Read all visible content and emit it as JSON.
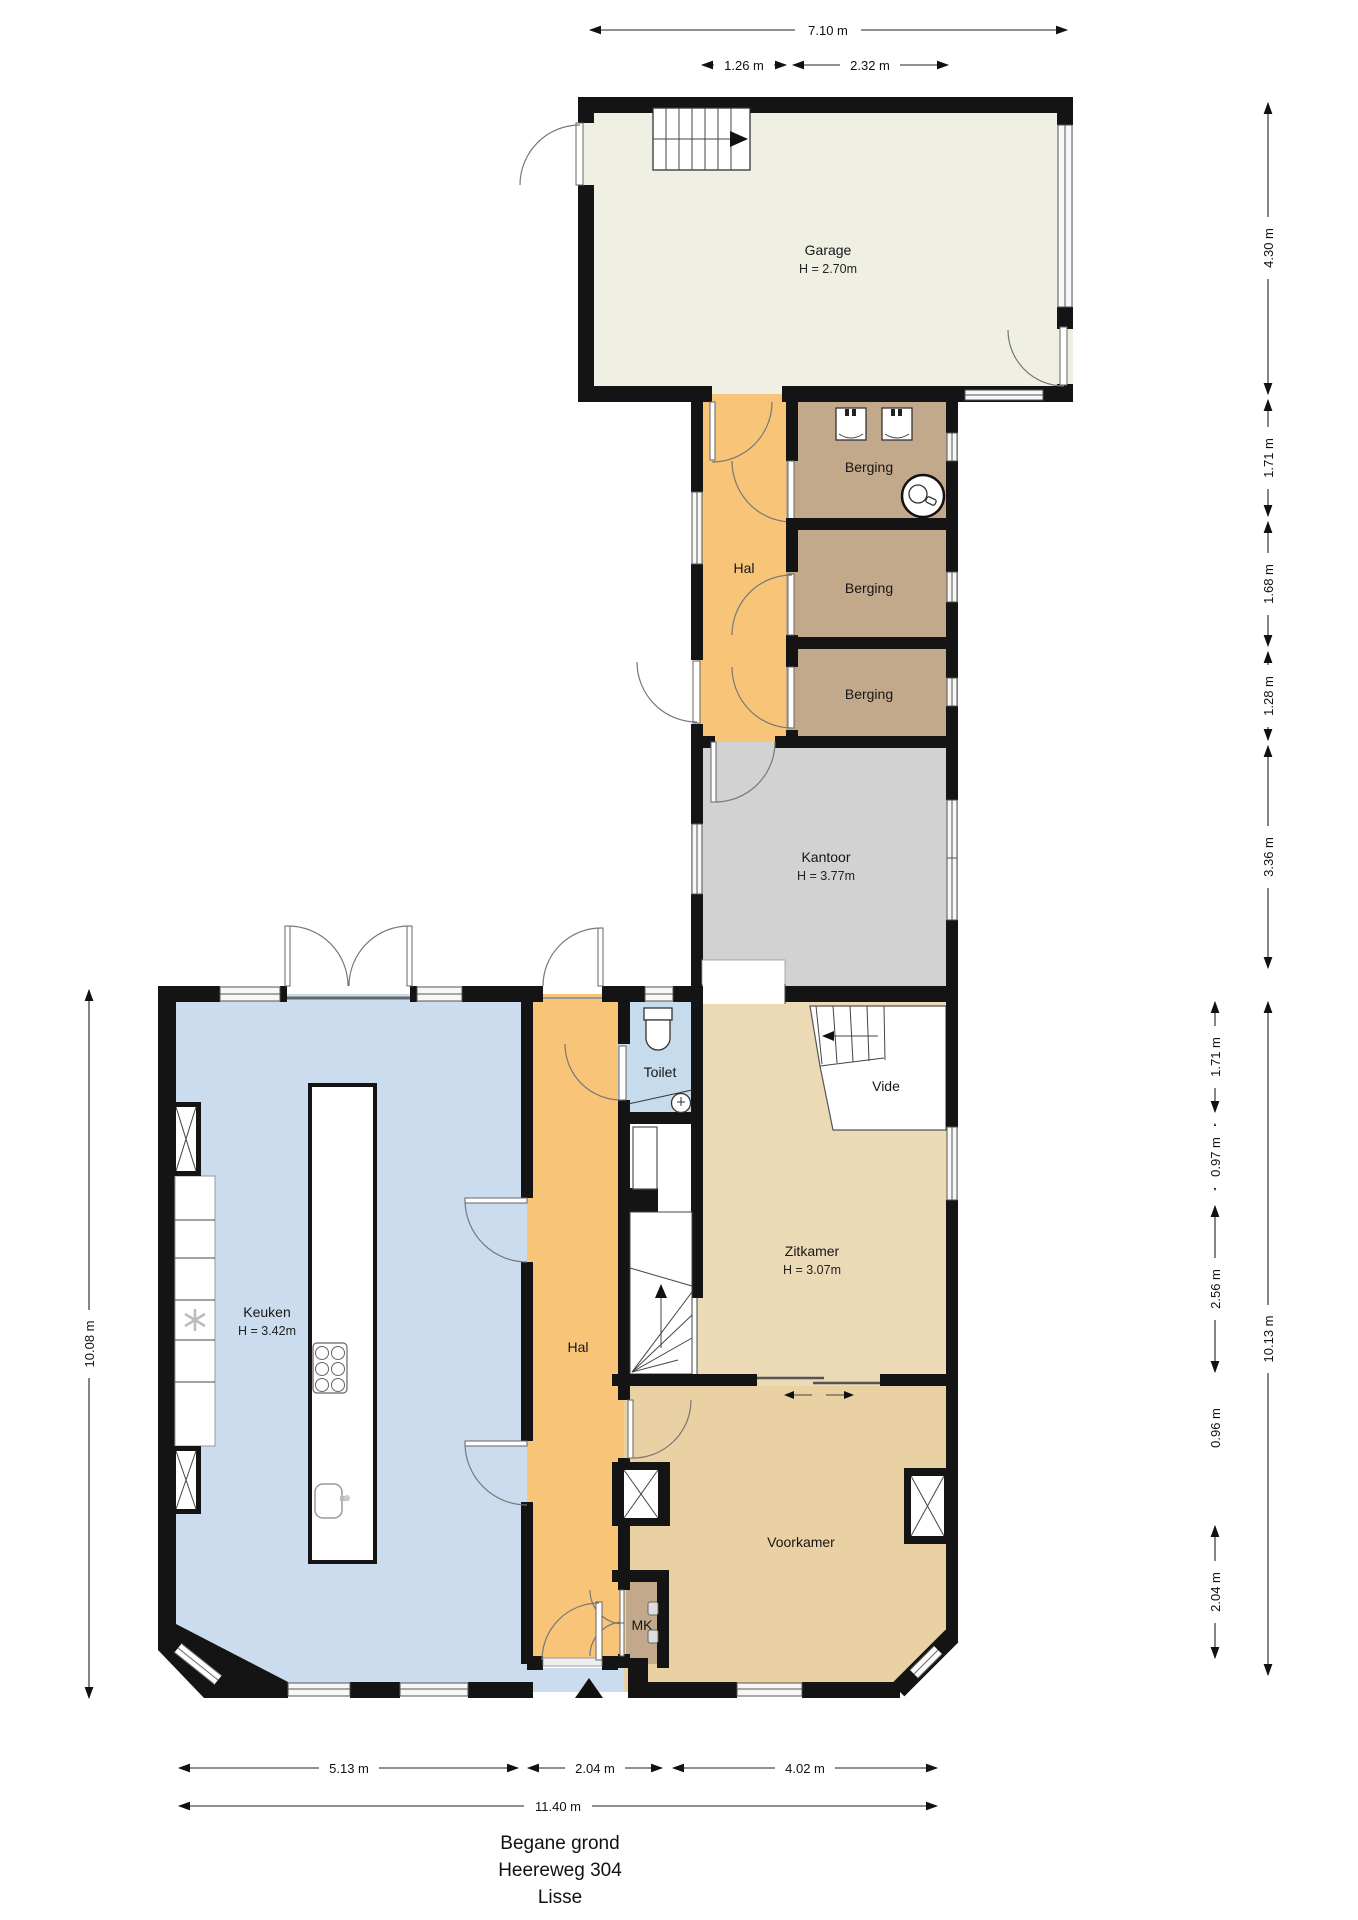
{
  "title": {
    "floor": "Begane grond",
    "street": "Heereweg 304",
    "city": "Lisse"
  },
  "rooms": {
    "garage": {
      "name": "Garage",
      "height": "H = 2.70m"
    },
    "hal_mid": {
      "name": "Hal"
    },
    "berging1": {
      "name": "Berging"
    },
    "berging2": {
      "name": "Berging"
    },
    "berging3": {
      "name": "Berging"
    },
    "kantoor": {
      "name": "Kantoor",
      "height": "H = 3.77m"
    },
    "keuken": {
      "name": "Keuken",
      "height": "H = 3.42m"
    },
    "hal_lower": {
      "name": "Hal"
    },
    "toilet": {
      "name": "Toilet"
    },
    "vide": {
      "name": "Vide"
    },
    "zitkamer": {
      "name": "Zitkamer",
      "height": "H = 3.07m"
    },
    "voorkamer": {
      "name": "Voorkamer"
    },
    "mk": {
      "name": "MK"
    }
  },
  "dimensions": {
    "top": {
      "total": "7.10 m",
      "hal": "1.26 m",
      "berging": "2.32 m"
    },
    "right_upper": {
      "garage": "4.30 m",
      "berging1": "1.71 m",
      "berging2": "1.68 m",
      "berging3": "1.28 m",
      "kantoor": "3.36 m"
    },
    "right_lower": {
      "seg1": "1.71 m",
      "seg2": "0.97 m",
      "seg3": "2.56 m",
      "seg4": "0.96 m",
      "seg5": "2.04 m",
      "total": "10.13 m"
    },
    "left": {
      "total": "10.08 m"
    },
    "bottom": {
      "keuken": "5.13 m",
      "hal": "2.04 m",
      "voorkamer": "4.02 m",
      "total": "11.40 m"
    }
  },
  "colors": {
    "wall": "#141414",
    "garage": "#f0efe4",
    "hal": "#f7c478",
    "berging": "#c3a98c",
    "kantoor": "#d2d2d2",
    "keuken": "#cbdcee",
    "toilet": "#c6dbec",
    "zitkamer": "#ecdab6",
    "voorkamer": "#e9d1a3"
  }
}
